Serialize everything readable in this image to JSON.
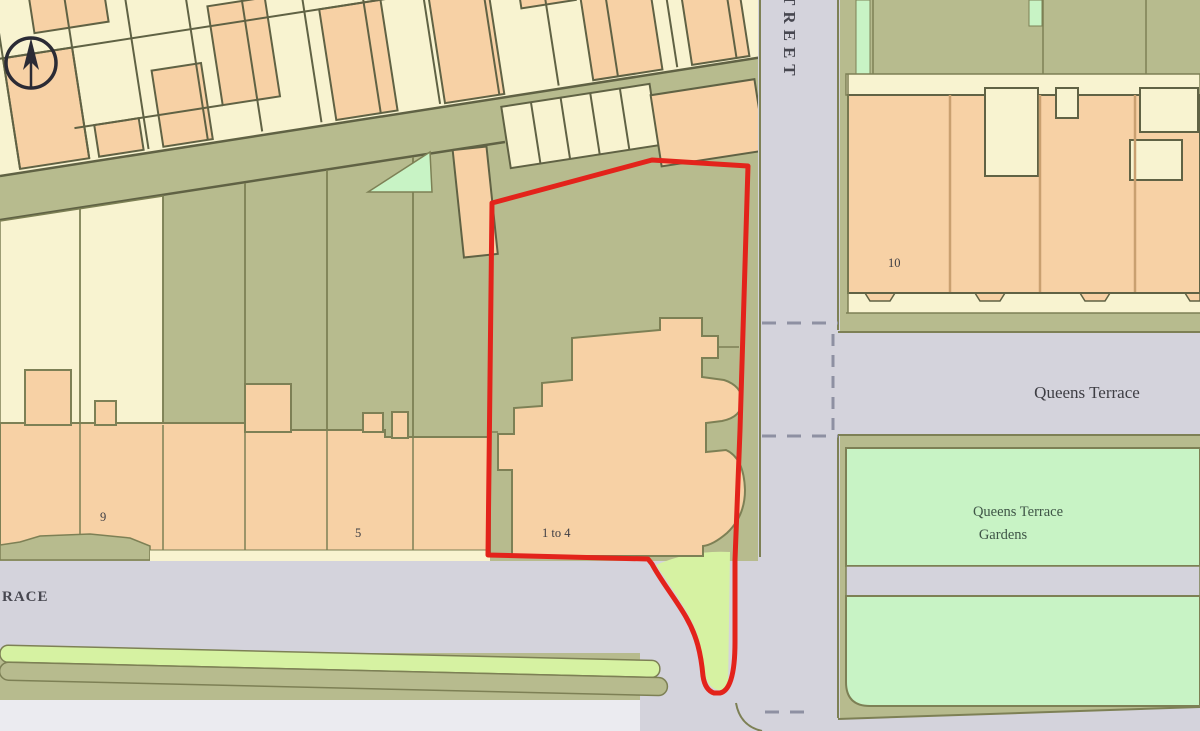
{
  "map": {
    "type": "site-location-plan",
    "labels": {
      "street_vertical": "TREET",
      "terrace_road_partial": "RACE",
      "queens_terrace_road": "Queens Terrace",
      "gardens_line1": "Queens Terrace",
      "gardens_line2": "Gardens",
      "plot_number": "1 to 4",
      "house_left": "9",
      "house_mid": "5",
      "house_right": "10"
    },
    "icons": {
      "north_arrow": "north-arrow-icon"
    },
    "colors": {
      "land_olive": "#b7bb8e",
      "building_peach": "#f7d1a5",
      "building_yellow": "#f8f3d0",
      "green_mint": "#c8f3c5",
      "green_lime": "#d6f2a2",
      "road_gray": "#d4d3dc",
      "road_pale": "#ebebf0",
      "outline_olive": "#7d8055",
      "outline_dark": "#606244",
      "party_tan": "#c9a070",
      "boundary_red": "#e3231b",
      "dash_gray": "#8e90a2",
      "text_dark": "#3e3e44",
      "text_road": "#474750",
      "text_gardens": "#3f5547",
      "north_arrow": "#2b2b35"
    }
  }
}
